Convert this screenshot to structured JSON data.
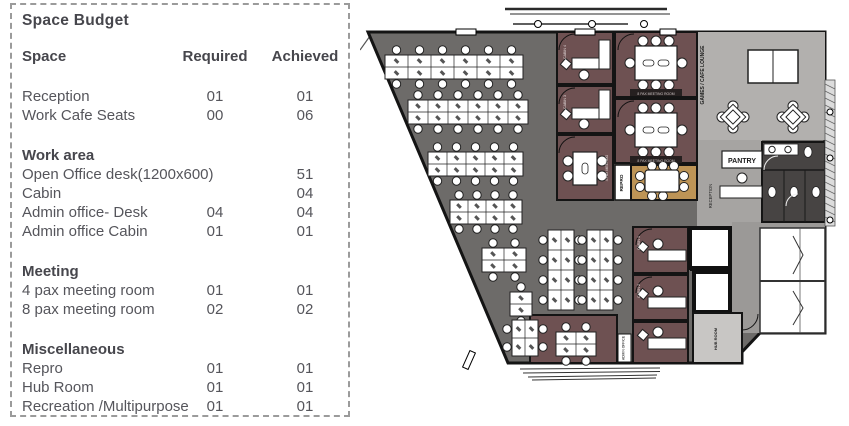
{
  "space_budget": {
    "title": "Space Budget",
    "columns": {
      "space": "Space",
      "required": "Required",
      "achieved": "Achieved"
    },
    "sections": [
      {
        "heading": "",
        "rows": [
          {
            "space": "Reception",
            "required": "01",
            "achieved": "01"
          },
          {
            "space": "Work Cafe Seats",
            "required": "00",
            "achieved": "06"
          }
        ]
      },
      {
        "heading": "Work area",
        "rows": [
          {
            "space": "Open Office desk(1200x600)",
            "required": "",
            "achieved": "51"
          },
          {
            "space": "Cabin",
            "required": "",
            "achieved": "04"
          },
          {
            "space": "Admin office- Desk",
            "required": "04",
            "achieved": "04"
          },
          {
            "space": "Admin office  Cabin",
            "required": "01",
            "achieved": "01"
          }
        ]
      },
      {
        "heading": "Meeting",
        "rows": [
          {
            "space": "4 pax meeting room",
            "required": "01",
            "achieved": "01"
          },
          {
            "space": "8 pax meeting room",
            "required": "02",
            "achieved": "02"
          }
        ]
      },
      {
        "heading": "Miscellaneous",
        "rows": [
          {
            "space": "Repro",
            "required": "01",
            "achieved": "01"
          },
          {
            "space": "Hub Room",
            "required": "01",
            "achieved": "01"
          },
          {
            "space": "Recreation /Multipurpose",
            "required": "01",
            "achieved": "01"
          }
        ]
      }
    ]
  },
  "floor_plan": {
    "labels": {
      "games_lounge": "GAMES / CAFE LOUNGE",
      "pantry": "PANTRY",
      "reception": "RECEPTION",
      "repro": "REPRO",
      "hub_room": "HUB ROOM",
      "cabin_4": "CABIN 4",
      "cabin_3": "CABIN 3",
      "cabin_1": "CABIN 1",
      "cabin_2": "CABIN 2",
      "meeting_8pax": "8 PAX MEETING ROOM",
      "meeting_4pax": "4 PAX MEETING",
      "admin_office": "ADMIN OFFICE"
    },
    "colors": {
      "open_office_floor": "#6d6b69",
      "lounge_floor": "#b2b0ae",
      "corridor_floor": "#a6a4a2",
      "cabin_floor": "#6e5152",
      "wood_floor": "#bd9456",
      "toilet_floor": "#474443",
      "wall": "#141414"
    }
  }
}
